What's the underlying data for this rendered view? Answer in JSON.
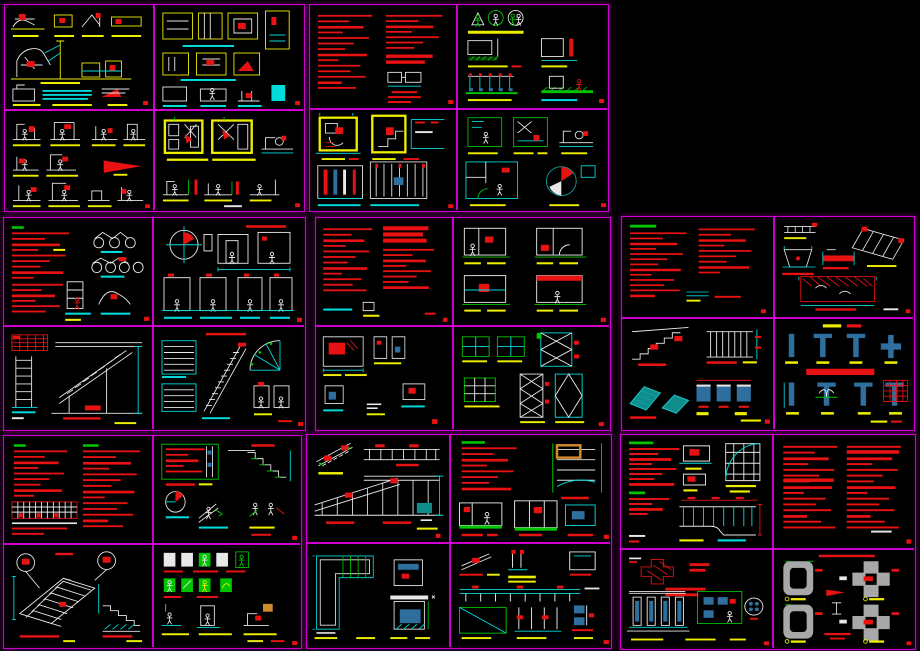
{
  "meta": {
    "width": 920,
    "height": 651,
    "background": "#000000",
    "description": "Montage of eight CAD construction-detail sheet groups (2x2 panels each) on a black model-space background"
  },
  "palette": {
    "sheet_border_magenta": "#cf00cf",
    "line_cyan": "#00dcdc",
    "line_white": "#e8e8e8",
    "annotation_red": "#e81212",
    "label_yellow": "#eded00",
    "line_green": "#00c400",
    "fill_steel_blue": "#2e6f9e",
    "fill_teal": "#0f8c8c",
    "fill_gray": "#a8a8a8",
    "accent_orange": "#cf8a2d"
  },
  "groups": [
    {
      "id": "sheet-group-1",
      "x": 4,
      "y": 4,
      "w": 301,
      "h": 208,
      "div_x": 148,
      "div_y": 104,
      "panels": [
        "a1",
        "a2",
        "a3",
        "a4"
      ]
    },
    {
      "id": "sheet-group-2",
      "x": 309,
      "y": 4,
      "w": 300,
      "h": 208,
      "div_x": 146,
      "div_y": 103,
      "panels": [
        "b1",
        "b2",
        "b3",
        "b4"
      ]
    },
    {
      "id": "sheet-group-3",
      "x": 3,
      "y": 217,
      "w": 303,
      "h": 214,
      "div_x": 148,
      "div_y": 107,
      "panels": [
        "c1",
        "c2",
        "c3",
        "c4"
      ]
    },
    {
      "id": "sheet-group-4",
      "x": 315,
      "y": 217,
      "w": 296,
      "h": 214,
      "div_x": 136,
      "div_y": 107,
      "panels": [
        "d1",
        "d2",
        "d3",
        "d4"
      ]
    },
    {
      "id": "sheet-group-5",
      "x": 621,
      "y": 216,
      "w": 294,
      "h": 215,
      "div_x": 151,
      "div_y": 100,
      "panels": [
        "e1",
        "e2",
        "e3",
        "e4"
      ]
    },
    {
      "id": "sheet-group-6",
      "x": 3,
      "y": 435,
      "w": 299,
      "h": 214,
      "div_x": 148,
      "div_y": 107,
      "panels": [
        "f1",
        "f2",
        "f3",
        "f4"
      ]
    },
    {
      "id": "sheet-group-7",
      "x": 306,
      "y": 434,
      "w": 306,
      "h": 215,
      "div_x": 142,
      "div_y": 107,
      "panels": [
        "g1",
        "g2",
        "g3",
        "g4"
      ]
    },
    {
      "id": "sheet-group-8",
      "x": 620,
      "y": 434,
      "w": 296,
      "h": 216,
      "div_x": 151,
      "div_y": 113,
      "panels": [
        "h1",
        "h2",
        "h3",
        "h4"
      ]
    }
  ]
}
